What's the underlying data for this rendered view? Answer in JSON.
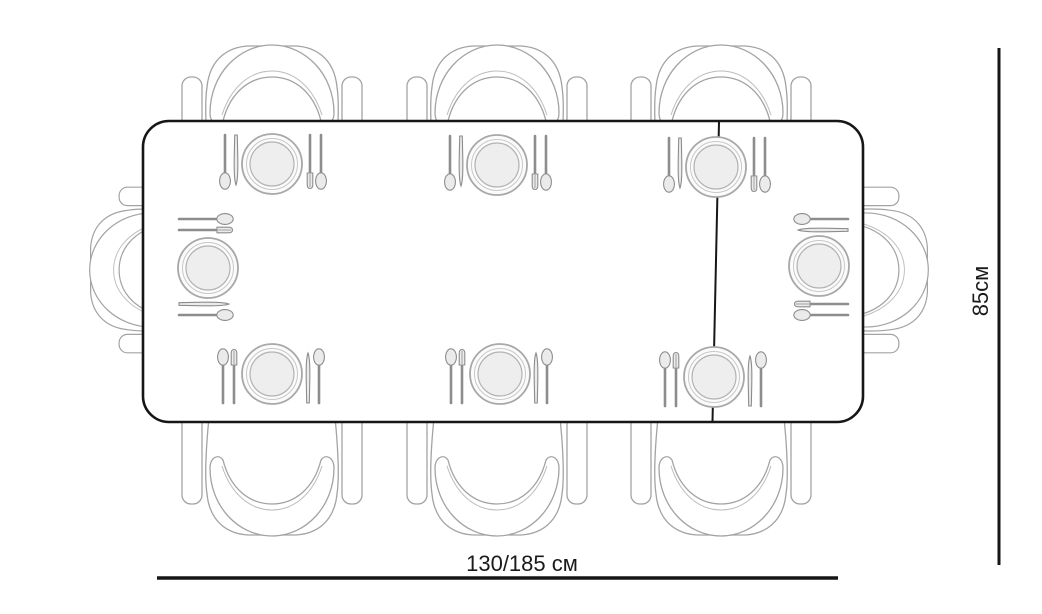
{
  "labels": {
    "table_length": "130/185 см",
    "table_depth": "85см"
  },
  "scene": {
    "view": "top-down",
    "chairs_count": 8,
    "place_settings_count": 8,
    "chairs_layout": {
      "top": 3,
      "bottom": 3,
      "left_end": 1,
      "right_end": 1
    },
    "table_has_extension_split_line": true
  },
  "colors": {
    "background": "#ffffff",
    "table_outline": "#161616",
    "dimension_line": "#161616",
    "sketch_stroke": "#a3a3a3",
    "plate_fill": "#eeeeee"
  }
}
